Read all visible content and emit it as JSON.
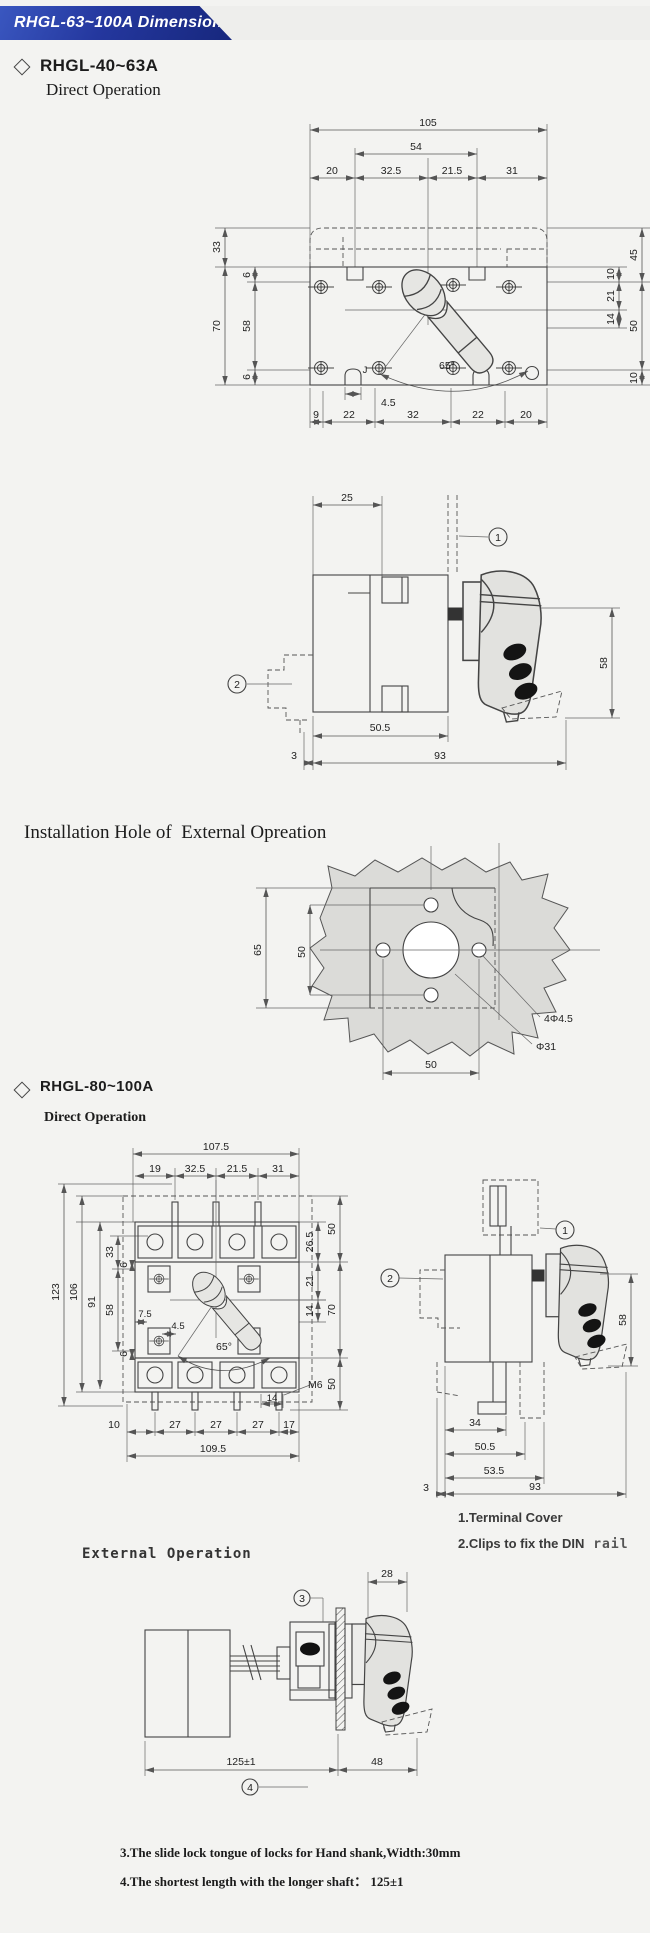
{
  "header": {
    "title": "RHGL-63~100A Dimension"
  },
  "sec1": {
    "title": "RHGL-40~63A",
    "subtitle": "Direct Operation"
  },
  "hole_title": "Installation Hole of  External Opreation",
  "sec2": {
    "title": "RHGL-80~100A",
    "subtitle": "Direct Operation"
  },
  "external_title": "External Operation",
  "notes": {
    "n1": "1.Terminal Cover",
    "n2": "2.Clips to fix the DIN",
    "n2_suffix": " rail",
    "n3": "3.The slide lock tongue of locks for Hand shank,Width:30mm",
    "n4": "4.The shortest length with the longer shaft：  125±1"
  },
  "d1": {
    "w_total": "105",
    "w_mid": "54",
    "wa": "20",
    "wb": "32.5",
    "wc": "21.5",
    "wd": "31",
    "h_a": "33",
    "h_b": "70",
    "h_c": "6",
    "h_d": "58",
    "h_e": "6",
    "r_a": "45",
    "r_b": "10",
    "r_c": "21",
    "r_d": "14",
    "r_e": "50",
    "r_f": "10",
    "angle": "65°",
    "j": "J",
    "slot": "4.5",
    "ba": "9",
    "bb": "22",
    "bc": "32",
    "bd": "22",
    "be": "20"
  },
  "d2": {
    "top": "25",
    "m1": "1",
    "m2": "2",
    "h": "58",
    "ba": "50.5",
    "bb": "3",
    "bc": "93"
  },
  "d3": {
    "la": "65",
    "lb": "50",
    "holes": "4Φ4.5",
    "dia": "Φ31",
    "bottom": "50"
  },
  "d4": {
    "w_total": "107.5",
    "wa": "19",
    "wb": "32.5",
    "wc": "21.5",
    "wd": "31",
    "la": "123",
    "lb": "106",
    "lc": "91",
    "ld": "58",
    "le": "33",
    "lf": "6",
    "lg": "6",
    "ra": "26.5",
    "rb": "50",
    "rc": "21",
    "rd": "14",
    "re": "70",
    "rf": "M6",
    "rg": "50",
    "ia": "7.5",
    "ib": "4.5",
    "angle": "65°",
    "pa": "14",
    "ba": "10",
    "bb": "27",
    "bc": "27",
    "bd": "27",
    "be": "17",
    "bf": "109.5"
  },
  "d5": {
    "m1": "1",
    "m2": "2",
    "h": "58",
    "ba": "34",
    "bb": "50.5",
    "bc": "53.5",
    "bd": "3",
    "be": "93"
  },
  "d6": {
    "m3": "3",
    "m4": "4",
    "top": "28",
    "ba": "125±1",
    "bb": "48"
  }
}
